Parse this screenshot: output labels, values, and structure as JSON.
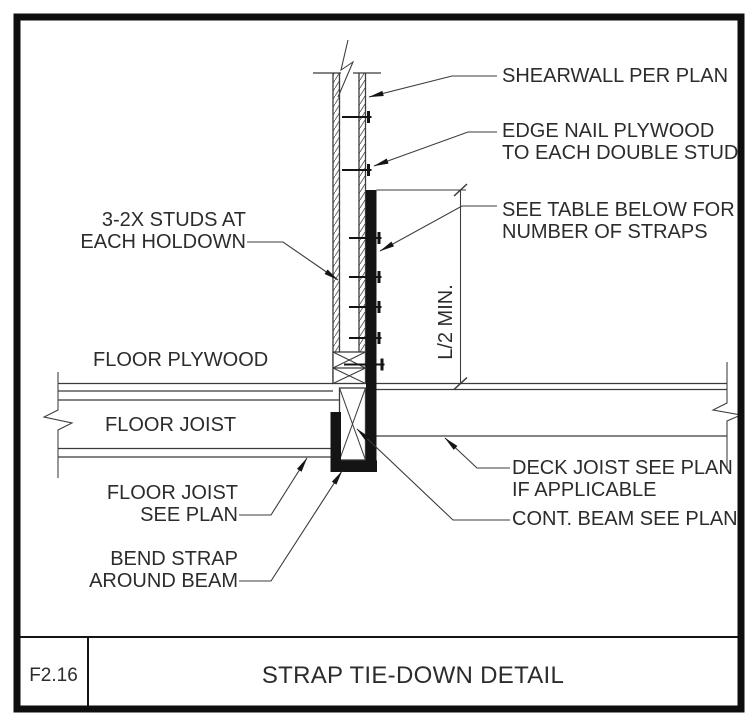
{
  "sheet": {
    "detail_number": "F2.16",
    "title": "STRAP TIE-DOWN DETAIL"
  },
  "callouts": {
    "shearwall": [
      "SHEARWALL PER PLAN"
    ],
    "edge_nail": [
      "EDGE NAIL PLYWOOD",
      "TO EACH DOUBLE STUD"
    ],
    "see_table": [
      "SEE TABLE BELOW FOR",
      "NUMBER OF STRAPS"
    ],
    "studs": [
      "3-2X STUDS AT",
      "EACH HOLDOWN"
    ],
    "floor_plywood": [
      "FLOOR PLYWOOD"
    ],
    "floor_joist": [
      "FLOOR JOIST"
    ],
    "floor_joist_see_plan": [
      "FLOOR JOIST",
      "SEE PLAN"
    ],
    "bend_strap": [
      "BEND STRAP",
      "AROUND BEAM"
    ],
    "deck_joist": [
      "DECK JOIST SEE PLAN",
      "IF APPLICABLE"
    ],
    "cont_beam": [
      "CONT. BEAM SEE PLAN"
    ]
  },
  "dimension": {
    "label": "L/2 MIN."
  },
  "colors": {
    "background": "#ffffff",
    "line": "#3b3b3b",
    "heavy": "#141414",
    "text": "#2c2c2c",
    "border": "#0e0e0e"
  }
}
